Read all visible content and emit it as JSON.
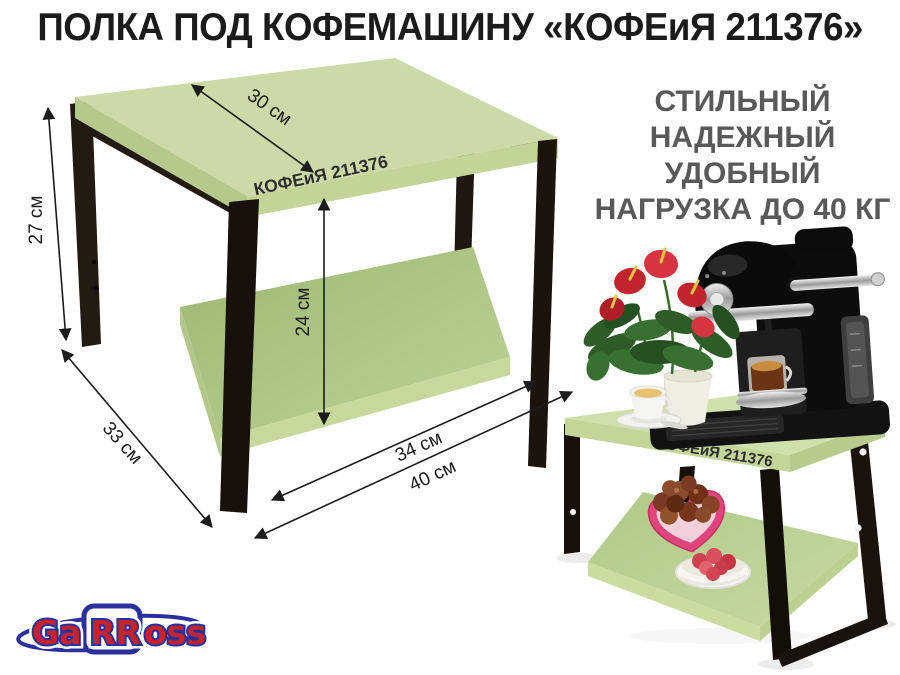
{
  "title": "ПОЛКА ПОД КОФЕМАШИНУ «КОФЕиЯ 211376»",
  "features": {
    "lines": [
      "СТИЛЬНЫЙ",
      "НАДЕЖНЫЙ",
      "УДОБНЫЙ",
      "НАГРУЗКА ДО 40 КГ"
    ]
  },
  "diagram": {
    "product_label": "КОФЕиЯ 211376",
    "height": "27 см",
    "top_depth": "30 см",
    "clearance": "24 см",
    "base_depth": "33 см",
    "shelf_width": "34 см",
    "total_width": "40 см"
  },
  "photo": {
    "product_label": "КОФЕиЯ 211376"
  },
  "brand": {
    "part1": "Ga",
    "part2": "RR",
    "part3": "oss"
  },
  "colors": {
    "shelf_green_top": "#cdd9a7",
    "shelf_green_edge": "#c2d498",
    "shelf_green_lower": "#a9c181",
    "metal_black": "#1d140e",
    "feature_text_gray": "#58595b",
    "logo_red": "#c4242b",
    "logo_blue": "#2b2f9e",
    "flower_red": "#c2242e",
    "candy_pink": "#e0457e"
  }
}
